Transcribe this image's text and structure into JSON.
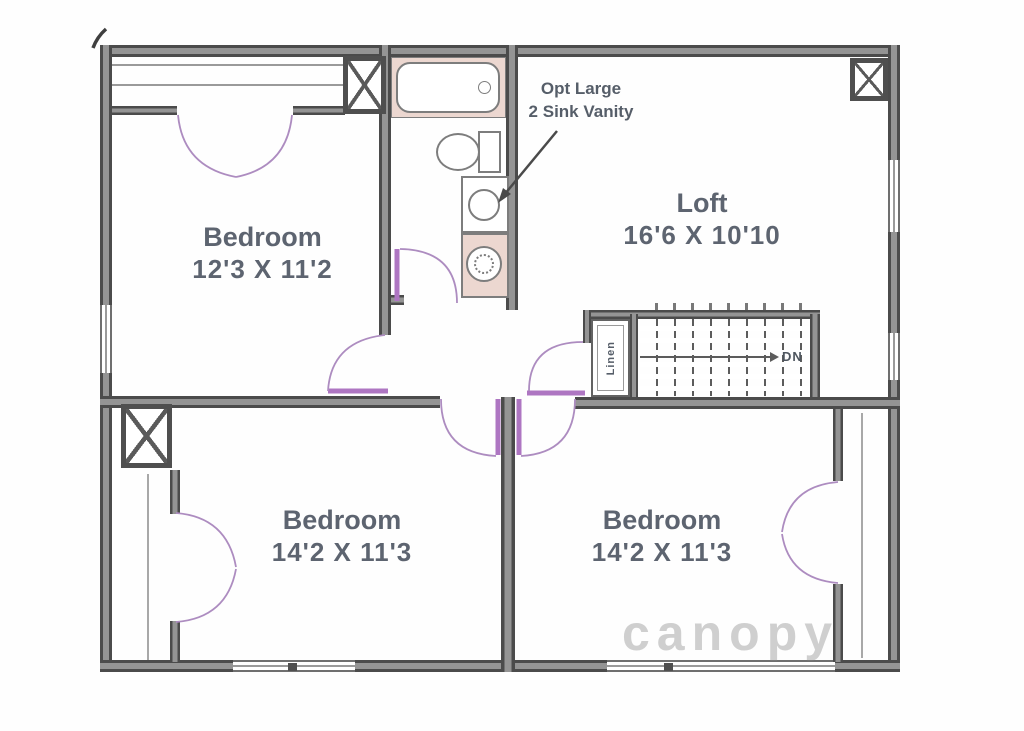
{
  "plan": {
    "rooms": [
      {
        "id": "bedroom-top-left",
        "name": "Bedroom",
        "dims": "12'3 X 11'2"
      },
      {
        "id": "loft",
        "name": "Loft",
        "dims": "16'6 X 10'10"
      },
      {
        "id": "bedroom-bottom-left",
        "name": "Bedroom",
        "dims": "14'2 X 11'3"
      },
      {
        "id": "bedroom-bottom-right",
        "name": "Bedroom",
        "dims": "14'2 X 11'3"
      }
    ],
    "annotation": {
      "line1": "Opt Large",
      "line2": "2 Sink Vanity"
    },
    "stairs": {
      "direction_label": "DN"
    },
    "linen_label": "Linen",
    "watermark": "canopy",
    "colors": {
      "wall": "#4b4b4b",
      "door_accent": "#ae76c2",
      "door_swing": "#ad8cc0",
      "fixture_pink": "#ecd7d0",
      "label_text": "#5d6470"
    }
  }
}
